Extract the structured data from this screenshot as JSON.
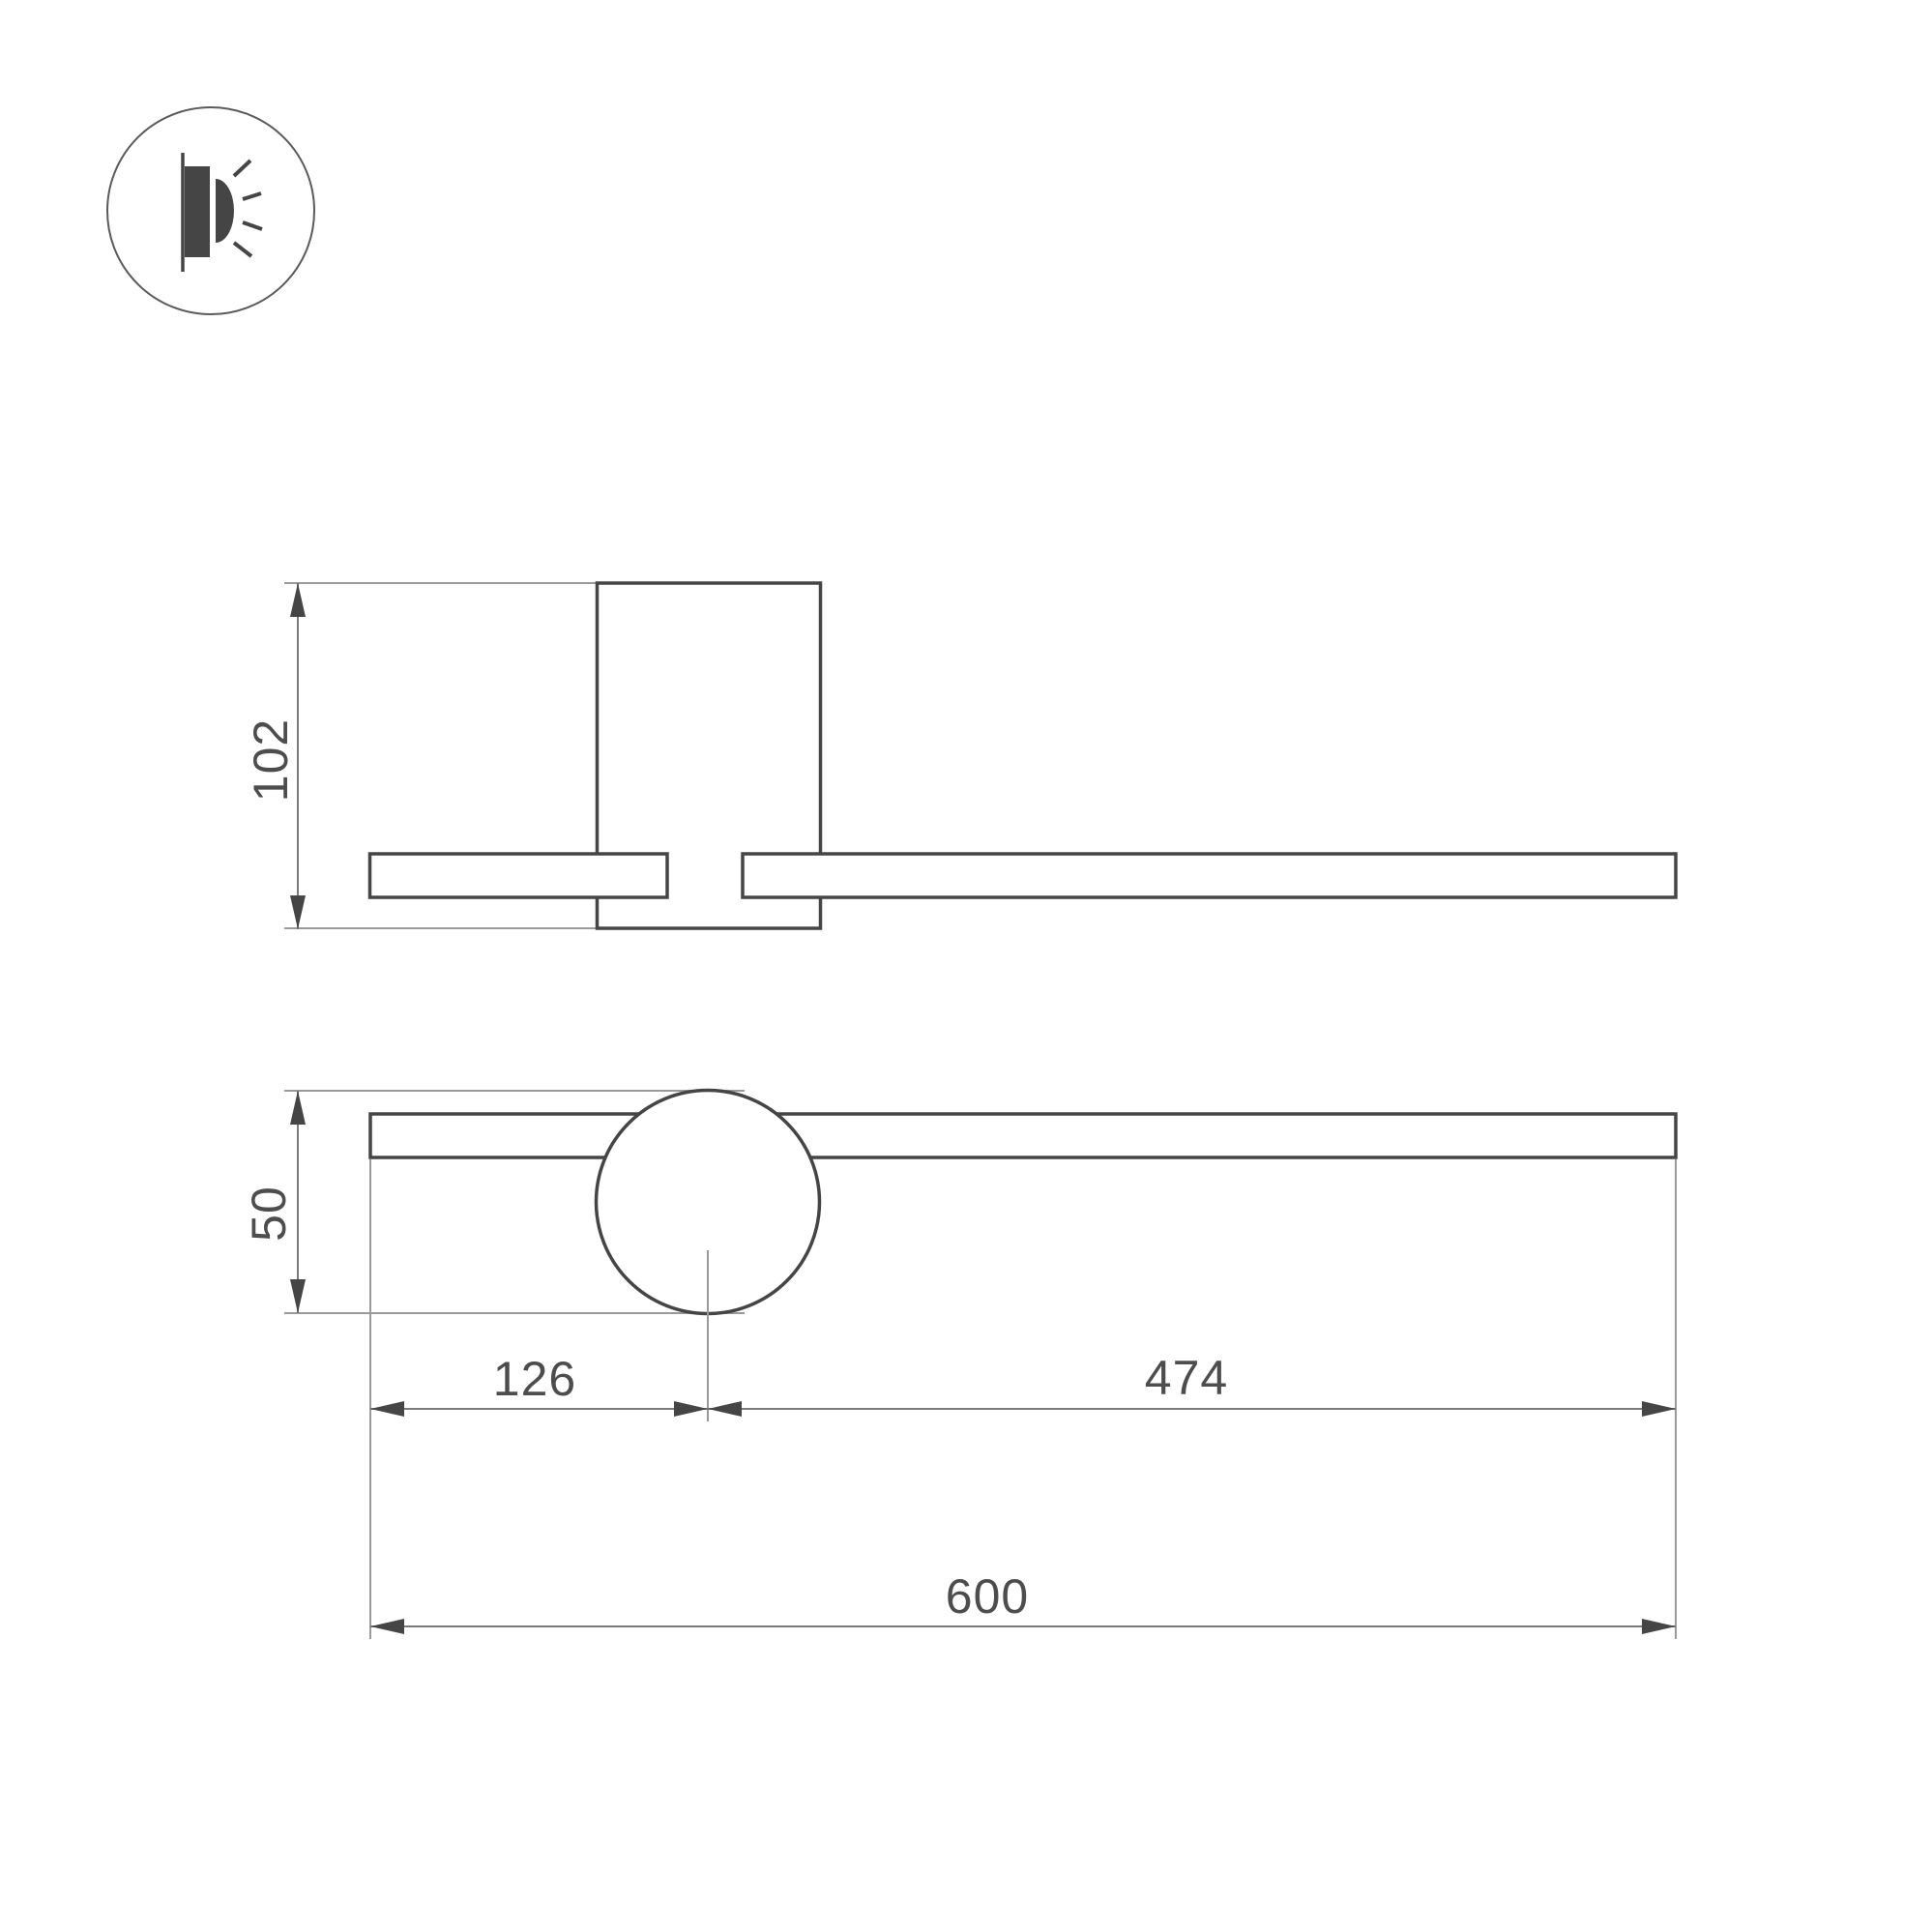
{
  "drawing": {
    "icon": {
      "type": "wall-mounted-light-icon"
    },
    "dimensions": {
      "side_height": "102",
      "front_height": "50",
      "center_offset_left": "126",
      "center_offset_right": "474",
      "total_length": "600"
    },
    "colors": {
      "outline": "#454545",
      "dimension_line": "#7a7a7a",
      "extension_line": "#9a9a9a",
      "label_text": "#4d4d4d",
      "background": "#ffffff"
    }
  }
}
